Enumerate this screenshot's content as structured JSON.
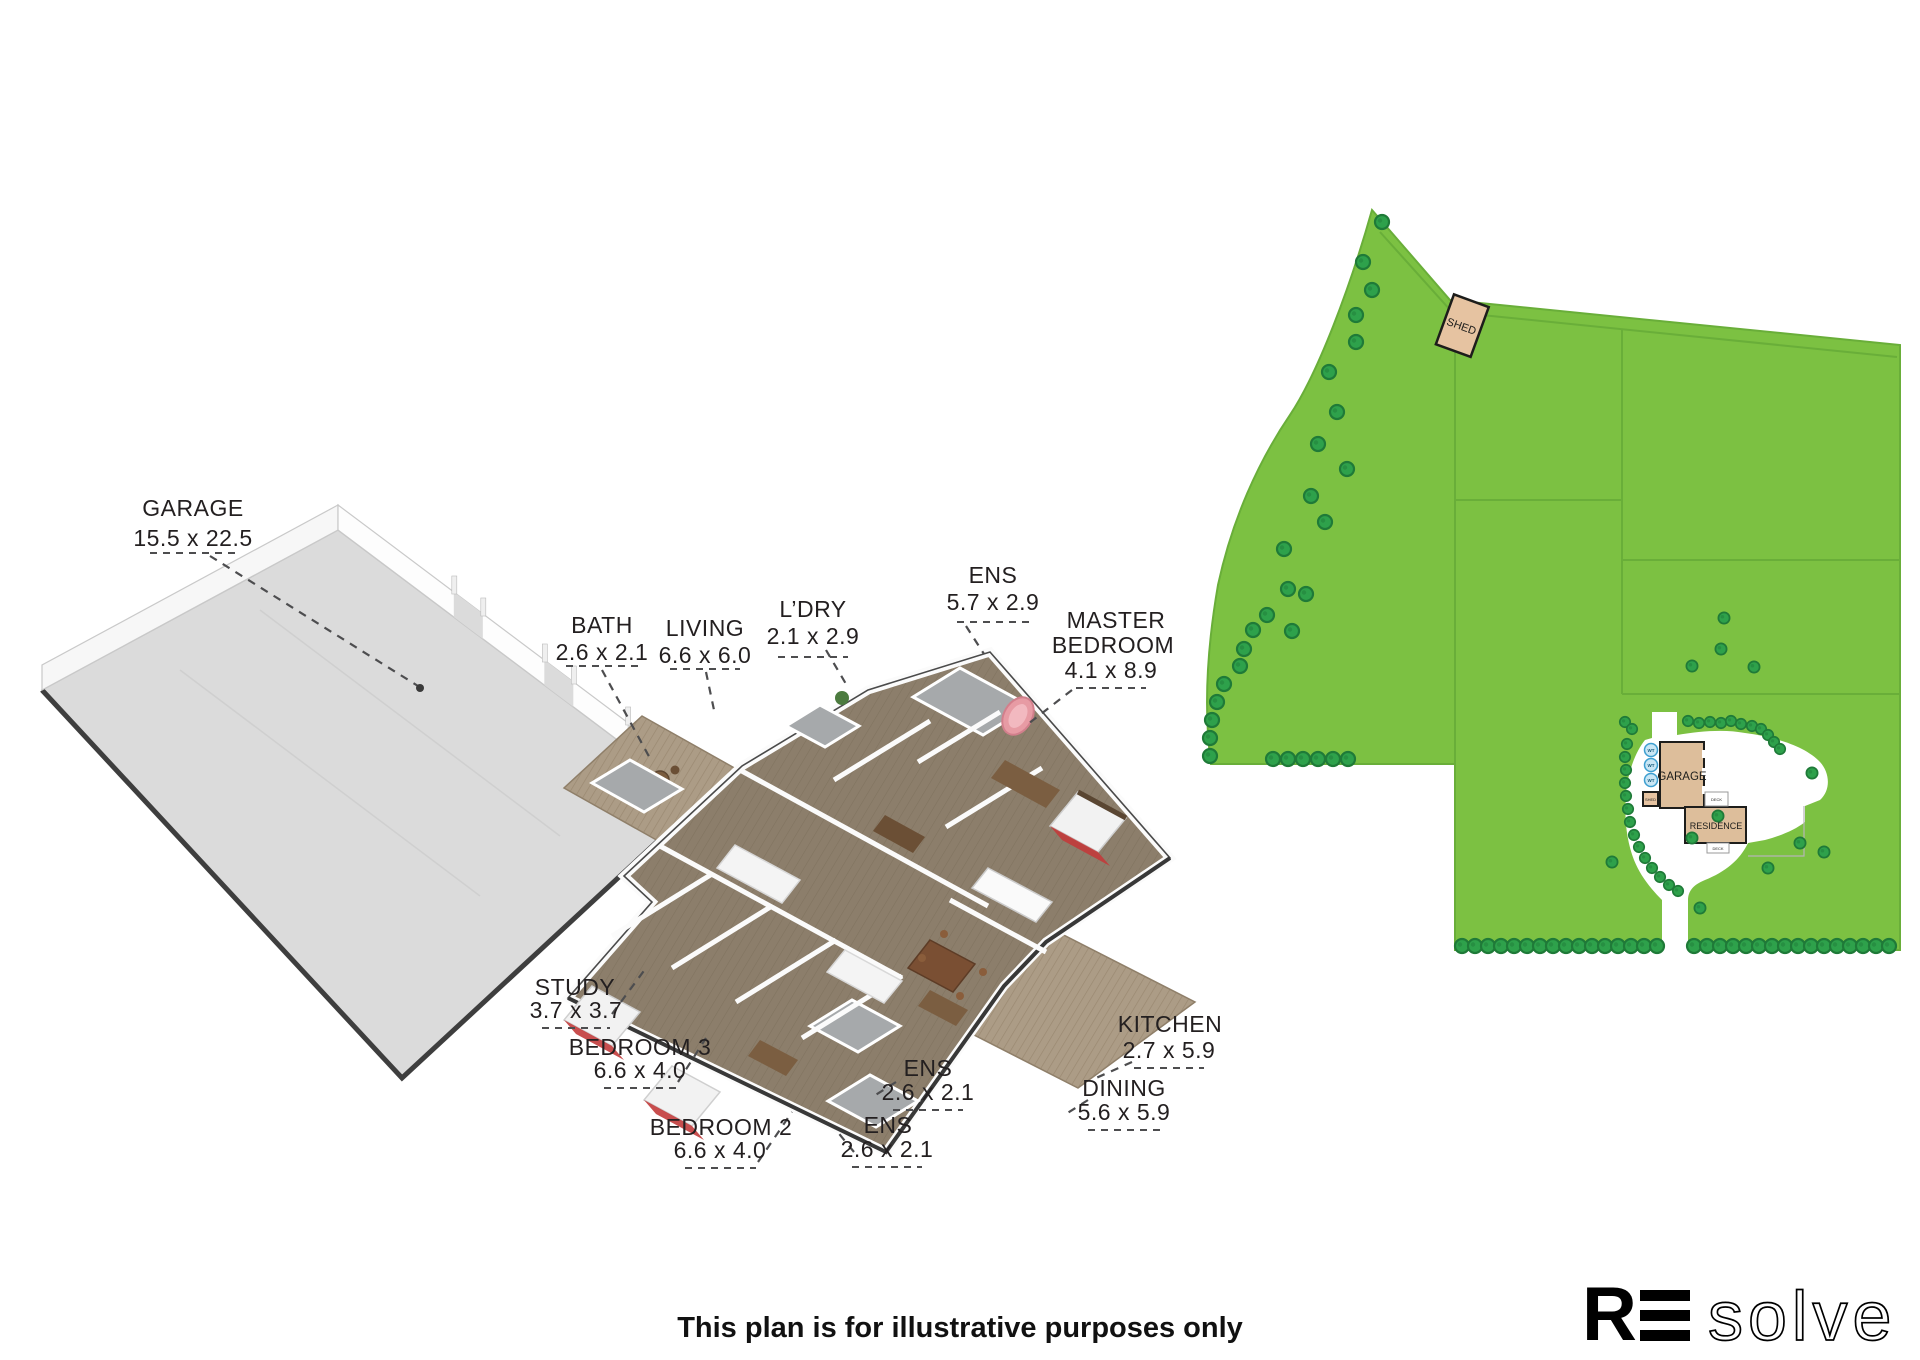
{
  "floor_plan": {
    "rooms": [
      {
        "id": "garage",
        "name": "GARAGE",
        "dims": "15.5 x 22.5"
      },
      {
        "id": "bath",
        "name": "BATH",
        "dims": "2.6 x 2.1"
      },
      {
        "id": "living",
        "name": "LIVING",
        "dims": "6.6 x 6.0"
      },
      {
        "id": "laundry",
        "name": "L’DRY",
        "dims": "2.1 x 2.9"
      },
      {
        "id": "ens-master",
        "name": "ENS",
        "dims": "5.7 x 2.9"
      },
      {
        "id": "master-bedroom",
        "name_line1": "MASTER",
        "name_line2": "BEDROOM",
        "dims": "4.1 x 8.9"
      },
      {
        "id": "study",
        "name": "STUDY",
        "dims": "3.7 x 3.7"
      },
      {
        "id": "bedroom-3",
        "name": "BEDROOM 3",
        "dims": "6.6 x 4.0"
      },
      {
        "id": "bedroom-2",
        "name": "BEDROOM 2",
        "dims": "6.6 x 4.0"
      },
      {
        "id": "ens-upper",
        "name": "ENS",
        "dims": "2.6 x 2.1"
      },
      {
        "id": "ens-lower",
        "name": "ENS",
        "dims": "2.6 x 2.1"
      },
      {
        "id": "kitchen",
        "name": "KITCHEN",
        "dims": "2.7 x 5.9"
      },
      {
        "id": "dining",
        "name": "DINING",
        "dims": "5.6 x 5.9"
      }
    ]
  },
  "site_plan": {
    "labels": {
      "shed": "SHED",
      "shed_small": "SHED",
      "garage": "GARAGE",
      "residence": "RESIDENCE",
      "deck_upper": "DECK",
      "deck_lower": "DECK",
      "water_tank": "WT"
    },
    "colors": {
      "grass": "#7CC142",
      "tree": "#2EA14B",
      "tree_outline": "#1F7A38",
      "building": "#DDBE9B",
      "boundary": "#69AE39",
      "water_tank_fill": "#C9E6F4",
      "water_tank_stroke": "#3E9FD0"
    }
  },
  "footer": {
    "disclaimer": "This plan is for illustrative purposes only"
  },
  "logo": {
    "bold": "R",
    "light": "solve",
    "alt": "RE solve"
  }
}
